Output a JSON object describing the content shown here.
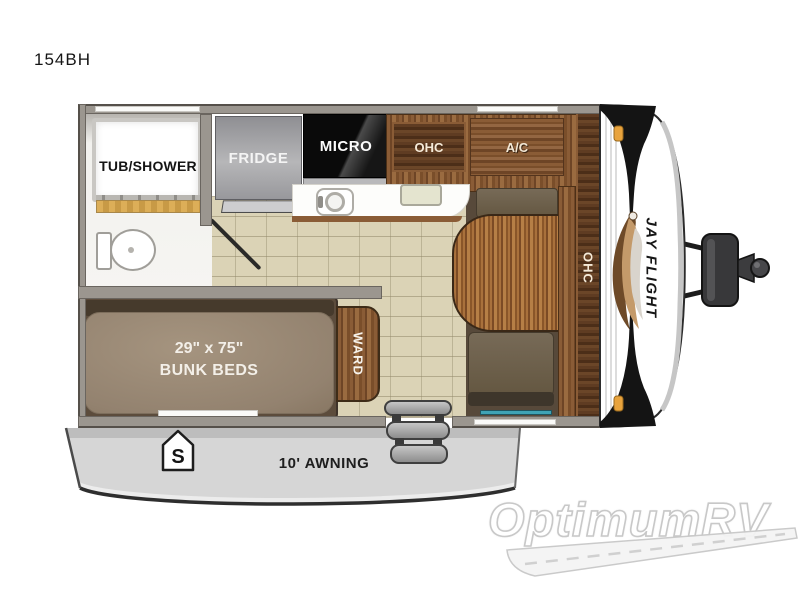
{
  "page": {
    "model": "154BH"
  },
  "rooms": {
    "bath": {
      "tub_label": "TUB/SHOWER"
    },
    "kitchen": {
      "fridge": "FRIDGE",
      "micro": "MICRO",
      "ohc": "OHC",
      "ac": "A/C"
    },
    "bunk": {
      "size": "29\" x 75\"",
      "name": "BUNK BEDS",
      "ward": "WARD"
    },
    "dinette": {
      "ohc": "OHC"
    }
  },
  "exterior": {
    "awning": "10' AWNING",
    "door_badge": "S",
    "brand_logo": "JAY FLIGHT"
  },
  "watermark": {
    "text": "OptimumRV"
  },
  "colors": {
    "wall": "#9b968f",
    "tile_floor": "#dbd3b6",
    "wood": "#8a5c36",
    "dark_wood": "#53341d",
    "mattress": "#9c8b78",
    "bench": "#6f6250",
    "marker_light": "#e8a33d",
    "teal_accent": "#3fa3b5",
    "awning_gray": "#d6d6d6"
  }
}
